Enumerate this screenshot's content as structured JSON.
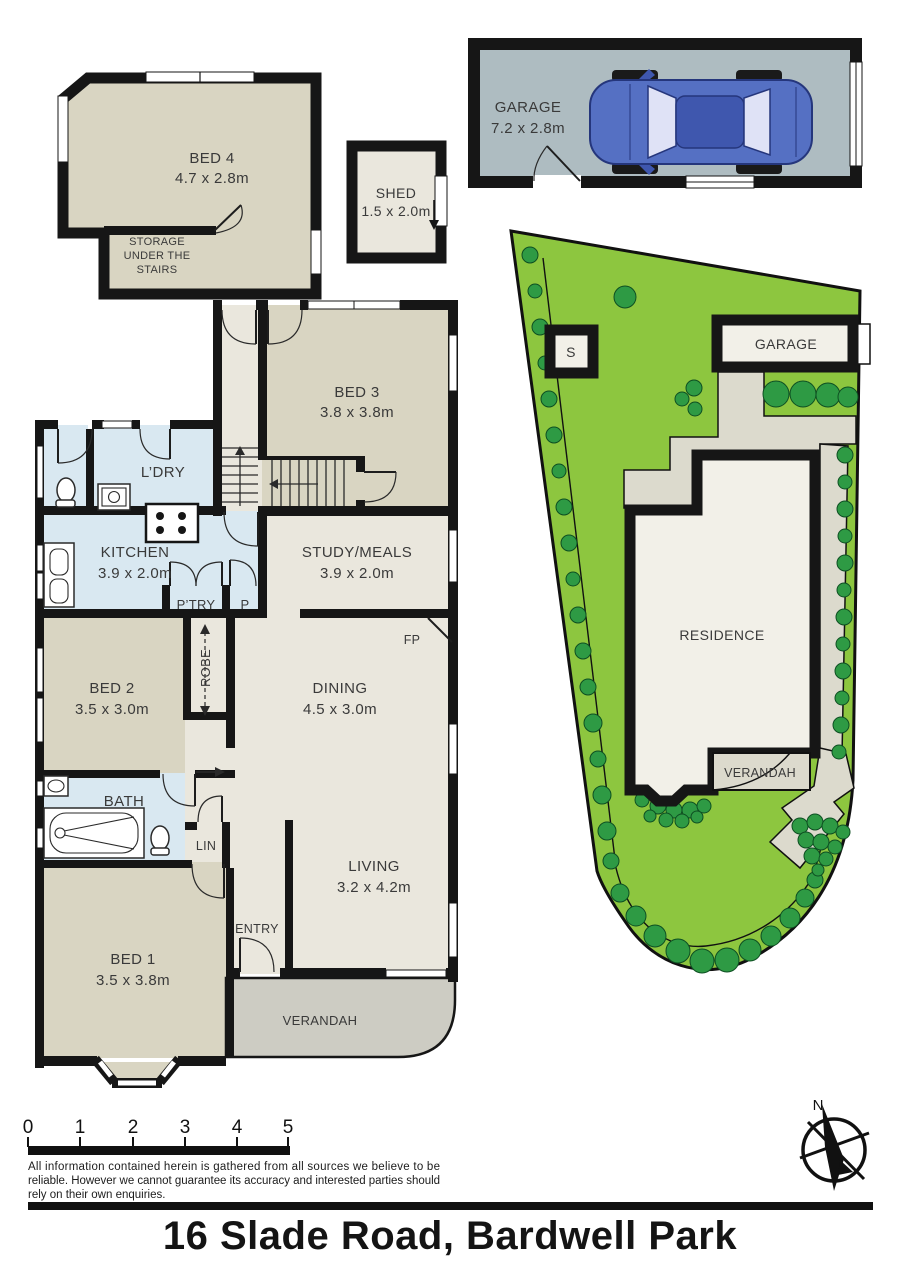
{
  "title": "16 Slade Road, Bardwell Park",
  "disclaimer_lines": [
    "All information contained herein is gathered from all sources we believe to be",
    "reliable. However we cannot guarantee its accuracy and interested parties should",
    "rely on their own enquiries."
  ],
  "scale_bar": {
    "ticks": [
      "0",
      "1",
      "2",
      "3",
      "4",
      "5"
    ]
  },
  "compass": {
    "north": "N"
  },
  "floorplan": {
    "bed4": {
      "name": "BED 4",
      "dims": "4.7 x 2.8m"
    },
    "storage": {
      "line1": "STORAGE",
      "line2": "UNDER THE",
      "line3": "STAIRS"
    },
    "shed": {
      "name": "SHED",
      "dims": "1.5 x 2.0m"
    },
    "garage": {
      "name": "GARAGE",
      "dims": "7.2 x 2.8m"
    },
    "bed3": {
      "name": "BED 3",
      "dims": "3.8 x 3.8m"
    },
    "ldry": {
      "name": "L’DRY"
    },
    "kitchen": {
      "name": "KITCHEN",
      "dims": "3.9 x 2.0m"
    },
    "ptry": {
      "name": "P’TRY"
    },
    "p": {
      "name": "P"
    },
    "study": {
      "name": "STUDY/MEALS",
      "dims": "3.9 x 2.0m"
    },
    "fp": {
      "name": "FP"
    },
    "bed2": {
      "name": "BED 2",
      "dims": "3.5 x 3.0m"
    },
    "robe": {
      "name": "ROBE"
    },
    "dining": {
      "name": "DINING",
      "dims": "4.5 x 3.0m"
    },
    "bath": {
      "name": "BATH"
    },
    "lin": {
      "name": "LIN"
    },
    "bed1": {
      "name": "BED 1",
      "dims": "3.5 x 3.8m"
    },
    "entry": {
      "name": "ENTRY"
    },
    "living": {
      "name": "LIVING",
      "dims": "3.2 x 4.2m"
    },
    "verandah": {
      "name": "VERANDAH"
    }
  },
  "site_plan": {
    "shed_label": "S",
    "garage_label": "GARAGE",
    "residence_label": "RESIDENCE",
    "verandah_label": "VERANDAH"
  },
  "colors": {
    "wall": "#161616",
    "room_khaki": "#d9d5c2",
    "room_beige": "#eae7dd",
    "room_blue": "#d9e8f1",
    "verandah_grey": "#cdccc3",
    "garage_floor": "#aebcc1",
    "lawn_green": "#8dc63f",
    "shrub_green": "#2e9a44",
    "path_beige": "#dcdacd",
    "site_building": "#f2f0e8",
    "car_body": "#5570c3",
    "car_roof": "#3f57ae",
    "car_glass": "#dfe2f6"
  }
}
